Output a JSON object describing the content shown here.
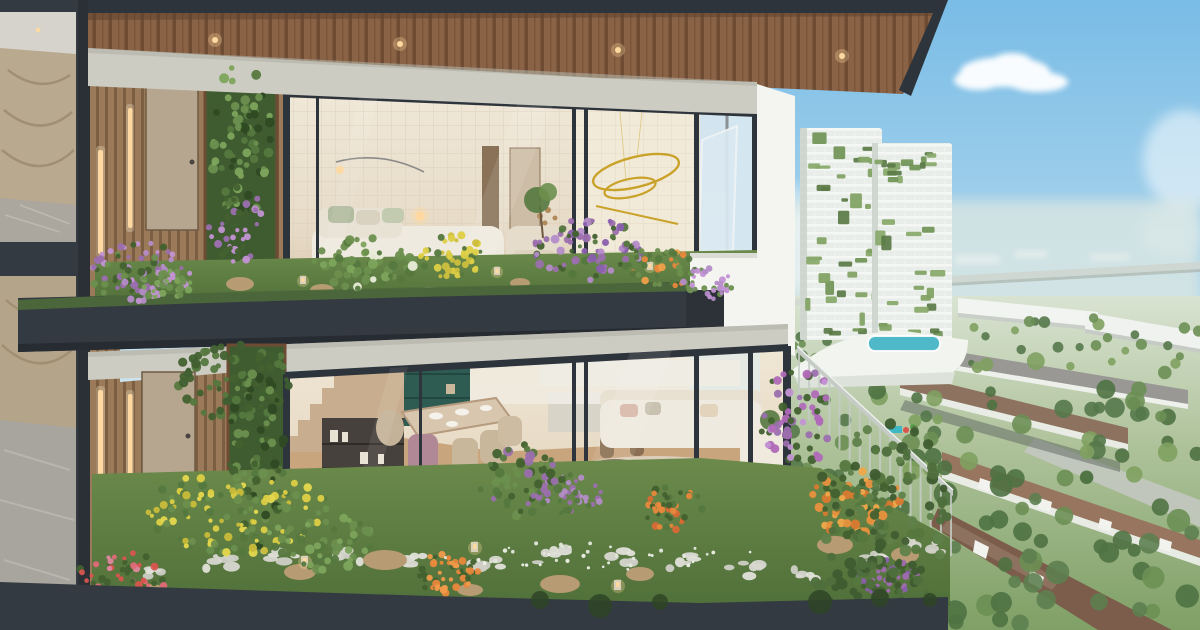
{
  "scene": {
    "type": "architectural-rendering",
    "subject": "duplex-sky-villa-cross-section-with-garden-balconies-overlooking-green-township",
    "palette": {
      "frame": "#343a41",
      "fascia": "#2e343b",
      "beam": "#cdccc3",
      "white": "#f4f4f1",
      "woodCeiling": "#8a6245",
      "woodCeilingDark": "#6e4c34",
      "slatWood": "#9a7a58",
      "slatShadow": "#7c5f42",
      "door": "#b7a68f",
      "interiorWall": "#e6dac6",
      "interiorCream": "#f0e8d8",
      "tileLine": "#d8cdb8",
      "floorWood": "#c9a57e",
      "bedWhite": "#efeadf",
      "sage": "#b2bc9f",
      "gold": "#c9a22a",
      "lampGlow": "#ffd9a0",
      "grass": "#6b8a4b",
      "grassDark": "#50703a",
      "leaf": "#5d7f45",
      "leafDark": "#406031",
      "purple": "#9b6fae",
      "purpleLight": "#c393d4",
      "lavender": "#b48cc8",
      "yellow": "#ddcf46",
      "orange": "#e8883c",
      "red": "#d8554e",
      "pink": "#e087a0",
      "pebble": "#d8d8d1",
      "rock": "#b79b72",
      "skyTop": "#79bce6",
      "skyMid": "#aed6ec",
      "skyLow": "#e3eef2",
      "haze": "#dce7e2",
      "cloud": "#ffffff",
      "towerBase": "#e9ede9",
      "towerGreen": "#6f9254",
      "podium": "#f2f4f0",
      "pool": "#4fb8c9",
      "roofBrown": "#8d7260",
      "roofGray": "#9a9894",
      "roadLight": "#c3c8c0",
      "roadDark": "#646e66",
      "treeGreen": "#6b8f54",
      "treeDark": "#4f7243",
      "cityHouseWall": "#eef0ec",
      "railing": "#c5ccc5",
      "deck": "#8a5c38",
      "deckDark": "#6b4527",
      "planterDark": "#2c3238"
    },
    "building": {
      "floors": 2,
      "features": [
        "dark-charcoal-frame",
        "wood-plank-soffit-with-downlights",
        "stone-beam-bands",
        "timber-slat-walls-with-linear-lights",
        "entry-doors",
        "vertical-green-walls",
        "glass-curtain-walls",
        "upper-bedroom-lounge",
        "gold-ring-chandelier",
        "lower-dining-kitchen-living",
        "staircase-with-shelving",
        "garden-terraces",
        "pebble-paths",
        "rocks",
        "flower-beds",
        "wood-deck",
        "white-parapet-volume",
        "dark-planter-box",
        "glass-balustrade",
        "marble-lobby-left"
      ]
    },
    "city": {
      "features": [
        "blue-sky",
        "clouds",
        "hazy-horizon",
        "elevated-highway",
        "two-green-facade-towers",
        "podium-with-pool",
        "playground",
        "white-midrise-blocks",
        "townhouse-rows-brown-roofs",
        "townhouse-rows-gray-roofs",
        "tree-lined-streets",
        "roads"
      ]
    }
  },
  "decor": {
    "clusters": [
      {
        "cx": 140,
        "cy": 272,
        "rx": 50,
        "ry": 30,
        "n": 80,
        "rmin": 2,
        "rmax": 4,
        "seed": 7,
        "colors": [
          "#6b8f4e",
          "#42612f",
          "#c393d4",
          "#9b6fae",
          "#b48cc8"
        ]
      },
      {
        "cx": 165,
        "cy": 284,
        "rx": 28,
        "ry": 16,
        "n": 35,
        "rmin": 2,
        "rmax": 4,
        "seed": 89,
        "colors": [
          "#6b8f4e",
          "#c393d4",
          "#7da45c"
        ]
      },
      {
        "cx": 368,
        "cy": 263,
        "rx": 55,
        "ry": 26,
        "n": 60,
        "rmin": 2.5,
        "rmax": 5,
        "seed": 11,
        "colors": [
          "#55783f",
          "#6b8f4e",
          "#7da45c",
          "#6b8f4e",
          "#e8ecd8"
        ]
      },
      {
        "cx": 452,
        "cy": 256,
        "rx": 32,
        "ry": 22,
        "n": 45,
        "rmin": 2,
        "rmax": 4,
        "seed": 13,
        "colors": [
          "#ddcf46",
          "#cdbf3e",
          "#55783f"
        ]
      },
      {
        "cx": 588,
        "cy": 250,
        "rx": 55,
        "ry": 33,
        "n": 85,
        "rmin": 2,
        "rmax": 4.5,
        "seed": 17,
        "colors": [
          "#9b6fae",
          "#b48cc8",
          "#55783f",
          "#42612f",
          "#8a5fae"
        ]
      },
      {
        "cx": 658,
        "cy": 268,
        "rx": 38,
        "ry": 20,
        "n": 40,
        "rmin": 2,
        "rmax": 4,
        "seed": 19,
        "colors": [
          "#6b8f4e",
          "#e8883c",
          "#55783f",
          "#f0a04a"
        ]
      },
      {
        "cx": 707,
        "cy": 284,
        "rx": 26,
        "ry": 16,
        "n": 40,
        "rmin": 2,
        "rmax": 3.5,
        "seed": 23,
        "colors": [
          "#c393d4",
          "#b48cc8",
          "#6b8f4e"
        ]
      },
      {
        "cx": 241,
        "cy": 140,
        "rx": 30,
        "ry": 80,
        "n": 70,
        "rmin": 2.5,
        "rmax": 5,
        "seed": 97,
        "colors": [
          "#55783f",
          "#6b8f4e",
          "#2f4a24",
          "#7da45c"
        ]
      },
      {
        "cx": 238,
        "cy": 225,
        "rx": 30,
        "ry": 38,
        "n": 40,
        "rmin": 2,
        "rmax": 4,
        "seed": 101,
        "colors": [
          "#9b6fae",
          "#c393d4",
          "#42612f"
        ]
      },
      {
        "cx": 232,
        "cy": 378,
        "rx": 58,
        "ry": 42,
        "n": 70,
        "rmin": 2.5,
        "rmax": 5,
        "seed": 29,
        "colors": [
          "#42612f",
          "#3f5f30",
          "#55783f"
        ]
      },
      {
        "cx": 256,
        "cy": 455,
        "rx": 28,
        "ry": 95,
        "n": 80,
        "rmin": 2.5,
        "rmax": 5,
        "seed": 103,
        "colors": [
          "#55783f",
          "#6b8f4e",
          "#2f4a24",
          "#42612f"
        ]
      },
      {
        "cx": 238,
        "cy": 512,
        "rx": 92,
        "ry": 42,
        "n": 120,
        "rmin": 2,
        "rmax": 4.5,
        "seed": 31,
        "colors": [
          "#ddcf46",
          "#e6d84e",
          "#55783f",
          "#6b8f4e",
          "#c9bc3a"
        ]
      },
      {
        "cx": 122,
        "cy": 578,
        "rx": 45,
        "ry": 26,
        "n": 60,
        "rmin": 2,
        "rmax": 4,
        "seed": 37,
        "colors": [
          "#e087a0",
          "#d8554e",
          "#e06a78",
          "#42612f"
        ]
      },
      {
        "cx": 446,
        "cy": 573,
        "rx": 33,
        "ry": 20,
        "n": 50,
        "rmin": 2,
        "rmax": 4,
        "seed": 41,
        "colors": [
          "#e8883c",
          "#f09a4a",
          "#42612f"
        ]
      },
      {
        "cx": 570,
        "cy": 494,
        "rx": 33,
        "ry": 20,
        "n": 45,
        "rmin": 2,
        "rmax": 3.5,
        "seed": 43,
        "colors": [
          "#9b6fae",
          "#b48cc8",
          "#55783f"
        ]
      },
      {
        "cx": 672,
        "cy": 508,
        "rx": 30,
        "ry": 24,
        "n": 45,
        "rmin": 2,
        "rmax": 4,
        "seed": 47,
        "colors": [
          "#d86a35",
          "#e8883c",
          "#55783f",
          "#42612f"
        ]
      },
      {
        "cx": 855,
        "cy": 502,
        "rx": 46,
        "ry": 36,
        "n": 70,
        "rmin": 2.5,
        "rmax": 5,
        "seed": 53,
        "colors": [
          "#e8913e",
          "#f0a84a",
          "#d87a30",
          "#42612f",
          "#55783f"
        ]
      },
      {
        "cx": 886,
        "cy": 576,
        "rx": 32,
        "ry": 20,
        "n": 45,
        "rmin": 2,
        "rmax": 4,
        "seed": 59,
        "colors": [
          "#a06ab0",
          "#8a5fae",
          "#42612f"
        ]
      },
      {
        "cx": 800,
        "cy": 415,
        "rx": 42,
        "ry": 48,
        "n": 60,
        "rmin": 2.5,
        "rmax": 4.5,
        "seed": 61,
        "colors": [
          "#c393d4",
          "#9b6fae",
          "#b06ab8",
          "#42612f"
        ]
      },
      {
        "cx": 320,
        "cy": 542,
        "rx": 60,
        "ry": 28,
        "n": 50,
        "rmin": 2.5,
        "rmax": 5,
        "seed": 67,
        "colors": [
          "#55783f",
          "#6b8f4e",
          "#7da45c"
        ]
      },
      {
        "cx": 600,
        "cy": 556,
        "rx": 160,
        "ry": 14,
        "n": 40,
        "rmin": 1.2,
        "rmax": 2.2,
        "seed": 71,
        "colors": [
          "#eef0e8",
          "#e4e8dc"
        ]
      },
      {
        "cx": 520,
        "cy": 480,
        "rx": 42,
        "ry": 38,
        "n": 60,
        "rmin": 2.5,
        "rmax": 5,
        "seed": 73,
        "colors": [
          "#55783f",
          "#6b8f4e",
          "#42612f",
          "#9b6fae"
        ]
      },
      {
        "cx": 885,
        "cy": 505,
        "rx": 68,
        "ry": 85,
        "n": 90,
        "rmin": 3,
        "rmax": 6,
        "seed": 79,
        "colors": [
          "#4e6e3c",
          "#5f814a",
          "#3f5c30",
          "#55783f"
        ]
      },
      {
        "cx": 870,
        "cy": 590,
        "rx": 60,
        "ry": 30,
        "n": 50,
        "rmin": 3,
        "rmax": 6,
        "seed": 83,
        "colors": [
          "#3f5c30",
          "#4e6e3c"
        ]
      }
    ],
    "trees": [
      {
        "x": 778,
        "y": 318,
        "w": 422,
        "h": 50,
        "n": 45,
        "rmin": 3,
        "rmax": 6,
        "seed": 201,
        "colors": [
          "#6b8f54",
          "#7fa161",
          "#55784a"
        ]
      },
      {
        "x": 778,
        "y": 360,
        "w": 422,
        "h": 120,
        "n": 55,
        "rmin": 5,
        "rmax": 10,
        "seed": 203,
        "colors": [
          "#6b8f54",
          "#7fa161",
          "#55784a",
          "#4f7243"
        ]
      },
      {
        "x": 930,
        "y": 470,
        "w": 270,
        "h": 155,
        "n": 40,
        "rmin": 6,
        "rmax": 12,
        "seed": 207,
        "colors": [
          "#4f7243",
          "#5d8050",
          "#6b8f54"
        ]
      },
      {
        "x": 770,
        "y": 430,
        "w": 170,
        "h": 160,
        "n": 20,
        "rmin": 6,
        "rmax": 10,
        "seed": 211,
        "colors": [
          "#4f7243",
          "#55784a"
        ]
      }
    ],
    "towers": [
      {
        "x": 802,
        "y": 130,
        "w": 78,
        "h": 206,
        "n": 36,
        "seed": 301
      },
      {
        "x": 874,
        "y": 145,
        "w": 76,
        "h": 198,
        "n": 34,
        "seed": 307
      }
    ],
    "towerGreens": [
      "#6f9254",
      "#87a869",
      "#5a7a45",
      "#7fa161"
    ],
    "balusters": {
      "x1": 799,
      "y1": 349,
      "x2": 951,
      "y2": 494,
      "n": 16,
      "len": 62
    },
    "pebbles": {
      "points": [
        [
          152,
          574
        ],
        [
          215,
          562
        ],
        [
          280,
          556
        ],
        [
          345,
          556
        ],
        [
          415,
          560
        ],
        [
          485,
          562
        ],
        [
          550,
          556
        ],
        [
          615,
          556
        ],
        [
          680,
          562
        ],
        [
          745,
          570
        ],
        [
          810,
          576
        ],
        [
          870,
          560
        ],
        [
          925,
          545
        ]
      ],
      "seed": 401,
      "stoneColors": [
        "#d8d8d1",
        "#cfcfc6",
        "#e2e2da"
      ]
    }
  }
}
